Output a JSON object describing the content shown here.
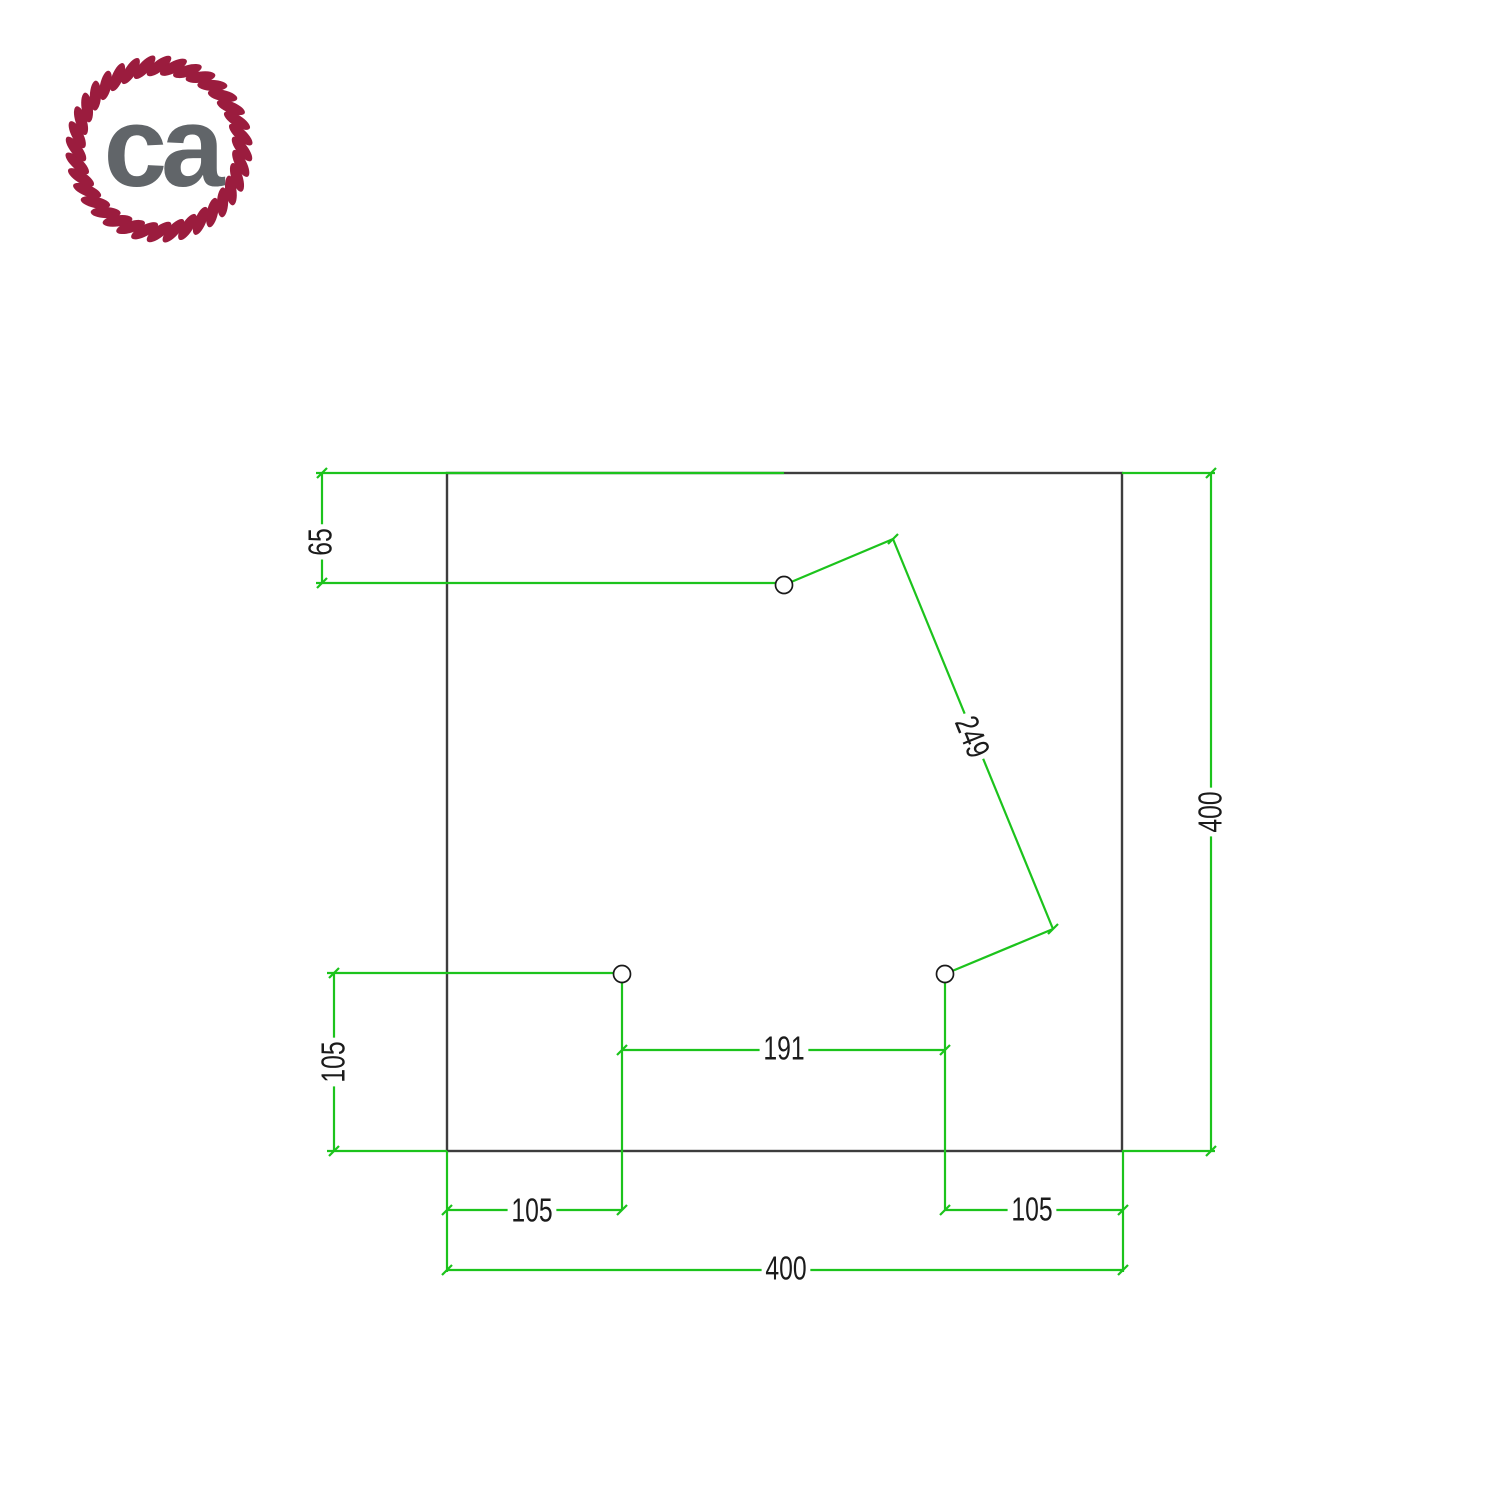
{
  "brand": {
    "logo_text": "ca",
    "rope_color": "#9b1c3e",
    "letters_color": "#616569"
  },
  "drawing": {
    "colors": {
      "dimension_lines": "#1cc31c",
      "plate_outline": "#3d3d3d",
      "label_text": "#1b1b1b"
    },
    "labels": {
      "top_hole_offset": "65",
      "diagonal_hole_distance": "249",
      "plate_height": "400",
      "left_hole_bottom_offset": "105",
      "bottom_holes_spacing": "191",
      "left_hole_inset": "105",
      "right_hole_inset": "105",
      "plate_width": "400"
    }
  }
}
